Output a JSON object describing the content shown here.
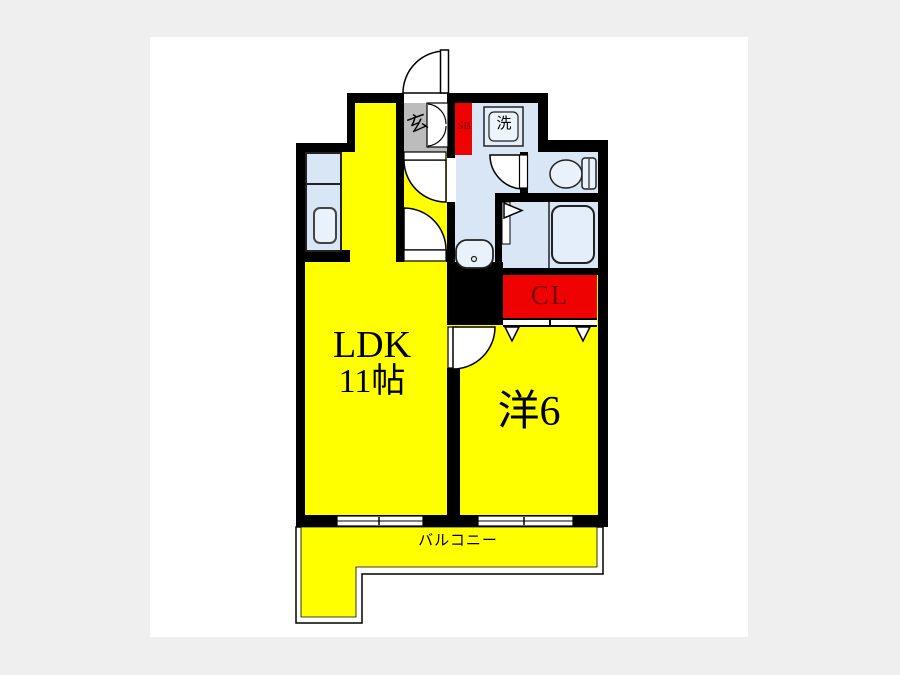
{
  "floorplan": {
    "type": "japanese-apartment-floorplan",
    "rooms": {
      "ldk": {
        "label_line1": "LDK",
        "label_line2": "11帖"
      },
      "western_room": {
        "label": "洋6"
      },
      "balcony": {
        "label": "バルコニー"
      },
      "closet": {
        "label": "CL"
      },
      "shoe_box": {
        "label": "SB"
      },
      "entrance": {
        "label": "玄"
      },
      "laundry": {
        "label": "洗"
      }
    },
    "colors": {
      "room_yellow": "#ffff00",
      "fixture_blue": "#d8e6f6",
      "accent_red": "#ee0202",
      "entrance_gray": "#bcbcbc",
      "wall_black": "#000000",
      "label_dark_red": "#7a0a0a",
      "page_margin_gray": "#efefef",
      "canvas_white": "#ffffff"
    }
  }
}
